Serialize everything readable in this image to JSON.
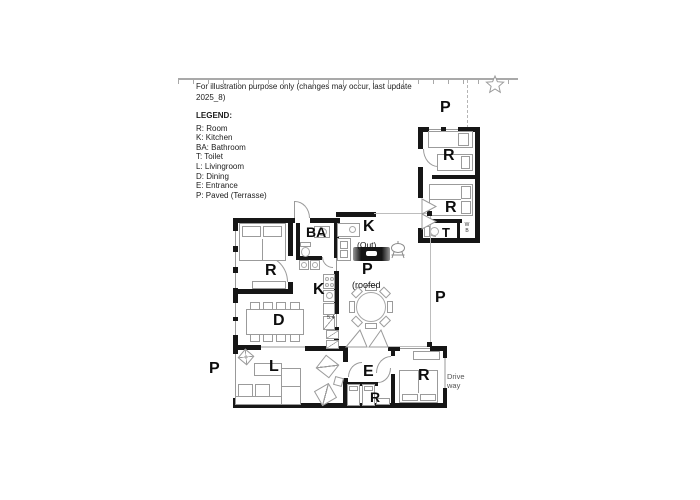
{
  "annotation": {
    "line1": "For illustration purpose only (changes may occur, last update",
    "line2": "2025_8)"
  },
  "legend": {
    "title": "LEGEND:",
    "items": [
      "R: Room",
      "K: Kitchen",
      "BA: Bathroom",
      "T: Toilet",
      "L: Livingroom",
      "D: Dining",
      "E: Entrance",
      "P: Paved (Terrasse)"
    ]
  },
  "rooms": {
    "paved_top": "P",
    "paved_right": "P",
    "paved_left": "P",
    "annex_r1": "R",
    "annex_r2": "R",
    "annex_toilet": "T",
    "annex_closet": "W B",
    "outdoor_kitchen": "K",
    "outdoor_kitchen_note": "(Out)",
    "terrace_paved": "P",
    "terrace_note": "(roofed",
    "bedroom_left": "R",
    "bathroom": "BA",
    "kitchen": "K",
    "dining": "D",
    "living": "L",
    "entrance": "E",
    "bedroom_small": "R",
    "bedroom_right": "R",
    "dimension": "5.4",
    "driveway_1": "Drive",
    "driveway_2": "way"
  },
  "colors": {
    "wall": "#161616",
    "furniture_stroke": "#9b9b9b",
    "thin_line": "#bdbdbd",
    "text": "#111111",
    "background": "#ffffff"
  }
}
